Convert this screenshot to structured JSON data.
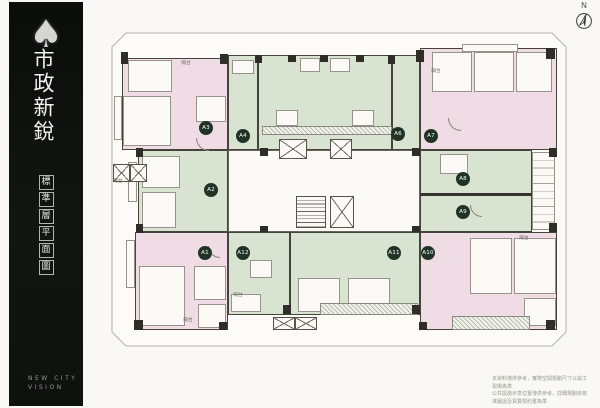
{
  "sidebar": {
    "logo_icon": "spade",
    "title": "市政新銳",
    "subtitle_boxed": "標準層平面圖",
    "footer_line1": "NEW CITY",
    "footer_line2": "VISION"
  },
  "compass": {
    "label": "N"
  },
  "plan": {
    "title": "標準層平面圖",
    "colors": {
      "pink_unit": "#efdce4",
      "green_unit": "#d8e4d1",
      "wall": "#2f2d28",
      "label_circle": "#203326",
      "property_line": "#b5b1a8"
    },
    "units": [
      {
        "label": "A1",
        "x": 205,
        "y": 253,
        "zone": "pink"
      },
      {
        "label": "A2",
        "x": 211,
        "y": 190,
        "zone": "green"
      },
      {
        "label": "A3",
        "x": 206,
        "y": 128,
        "zone": "pink"
      },
      {
        "label": "A4",
        "x": 243,
        "y": 136,
        "zone": "green"
      },
      {
        "label": "A6",
        "x": 398,
        "y": 134,
        "zone": "green"
      },
      {
        "label": "A7",
        "x": 431,
        "y": 136,
        "zone": "pink"
      },
      {
        "label": "A8",
        "x": 463,
        "y": 179,
        "zone": "green"
      },
      {
        "label": "A9",
        "x": 463,
        "y": 212,
        "zone": "green"
      },
      {
        "label": "A10",
        "x": 428,
        "y": 253,
        "zone": "pink"
      },
      {
        "label": "A11",
        "x": 394,
        "y": 253,
        "zone": "green"
      },
      {
        "label": "A12",
        "x": 243,
        "y": 253,
        "zone": "green"
      }
    ],
    "room_labels": [
      {
        "text": "陽台",
        "x": 186,
        "y": 63
      },
      {
        "text": "陽台",
        "x": 436,
        "y": 71
      },
      {
        "text": "陽台",
        "x": 118,
        "y": 181
      },
      {
        "text": "陽台",
        "x": 238,
        "y": 295
      },
      {
        "text": "陽台",
        "x": 188,
        "y": 320
      },
      {
        "text": "陽台",
        "x": 524,
        "y": 238
      }
    ]
  },
  "disclaimer": {
    "line1": "本資料僅供參考，實際空間規劃尺寸以竣工現場為準",
    "line2": "公共設施示意位置僅供參考，詳細規劃依核准圖說及買賣契約書為準"
  }
}
